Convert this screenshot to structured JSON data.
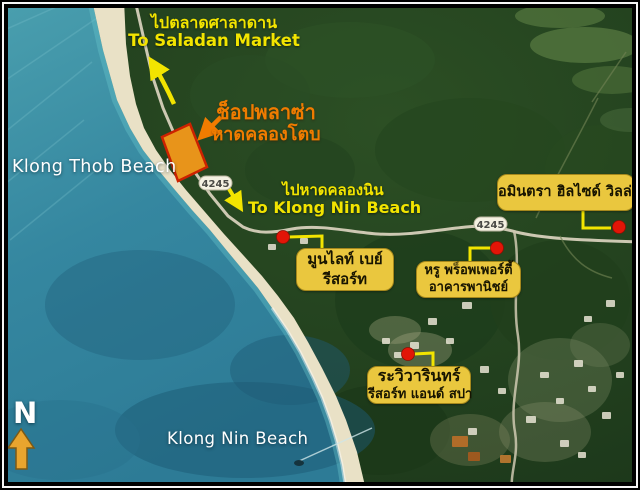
{
  "map": {
    "description": "Aerial map of Klong Tob / Klong Nin beach area with resort callouts",
    "region_labels": {
      "klong_thob_beach": "Klong Thob Beach",
      "klong_nin_beach": "Klong Nin Beach"
    },
    "direction_notes": [
      {
        "th": "ไปตลาดศาลาดาน",
        "en": "To Saladan Market"
      },
      {
        "th": "ไปหาดคลองนิน",
        "en": "To Klong Nin Beach"
      }
    ],
    "highlight": {
      "line1": "ช็อปพลาซ่า",
      "line2": "หาดคลองโตบ"
    },
    "road_markers": [
      {
        "number": "4245"
      },
      {
        "number": "4245"
      }
    ],
    "places": [
      {
        "line1": "อมินตรา ฮิลไซด์ วิลล่า",
        "line2": ""
      },
      {
        "line1": "มูนไลท์ เบย์",
        "line2": "รีสอร์ท"
      },
      {
        "line1": "หรู พร็อพเพอร์ตี้",
        "line2": "อาคารพานิชย์"
      },
      {
        "line1": "ระวิวารินทร์",
        "line2": "รีสอร์ท แอนด์ สปา"
      }
    ],
    "compass": {
      "label": "N"
    },
    "colors": {
      "sea": "#3587a0",
      "sand": "#e9e1c6",
      "forest": "#1c371b",
      "note_yellow": "#f2e400",
      "highlight_orange": "#f07c00",
      "callout_bg": "#eac73e",
      "callout_text": "#171400",
      "poi_dot_red": "#e21507",
      "plaza_fill": "#e8941a",
      "plaza_border": "#cc2200",
      "compass_arrow": "#e9a52e"
    }
  }
}
